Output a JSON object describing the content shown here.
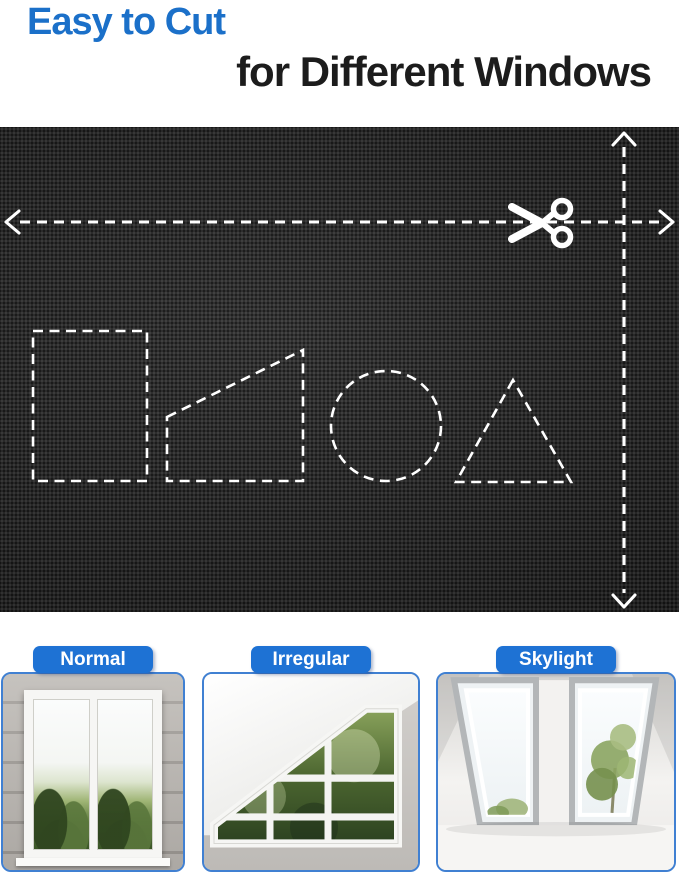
{
  "header": {
    "title_line1": "Easy to Cut",
    "title_line2": "for Different Windows"
  },
  "colors": {
    "title_blue": "#1b70c9",
    "title_dark": "#1c1c1c",
    "fabric_base": "#262626",
    "guide_white": "#ffffff",
    "pill_blue": "#1e72d4",
    "card_border": "#4080d2",
    "page_bg": "#ffffff"
  },
  "fabric_panel": {
    "icons": [
      "scissors-icon",
      "arrow-left-icon",
      "arrow-right-icon",
      "arrow-up-icon",
      "arrow-down-icon"
    ],
    "cut_shapes": [
      "rectangle",
      "trapezoid",
      "circle",
      "triangle"
    ]
  },
  "window_cards": [
    {
      "label": "Normal"
    },
    {
      "label": "Irregular"
    },
    {
      "label": "Skylight"
    }
  ]
}
